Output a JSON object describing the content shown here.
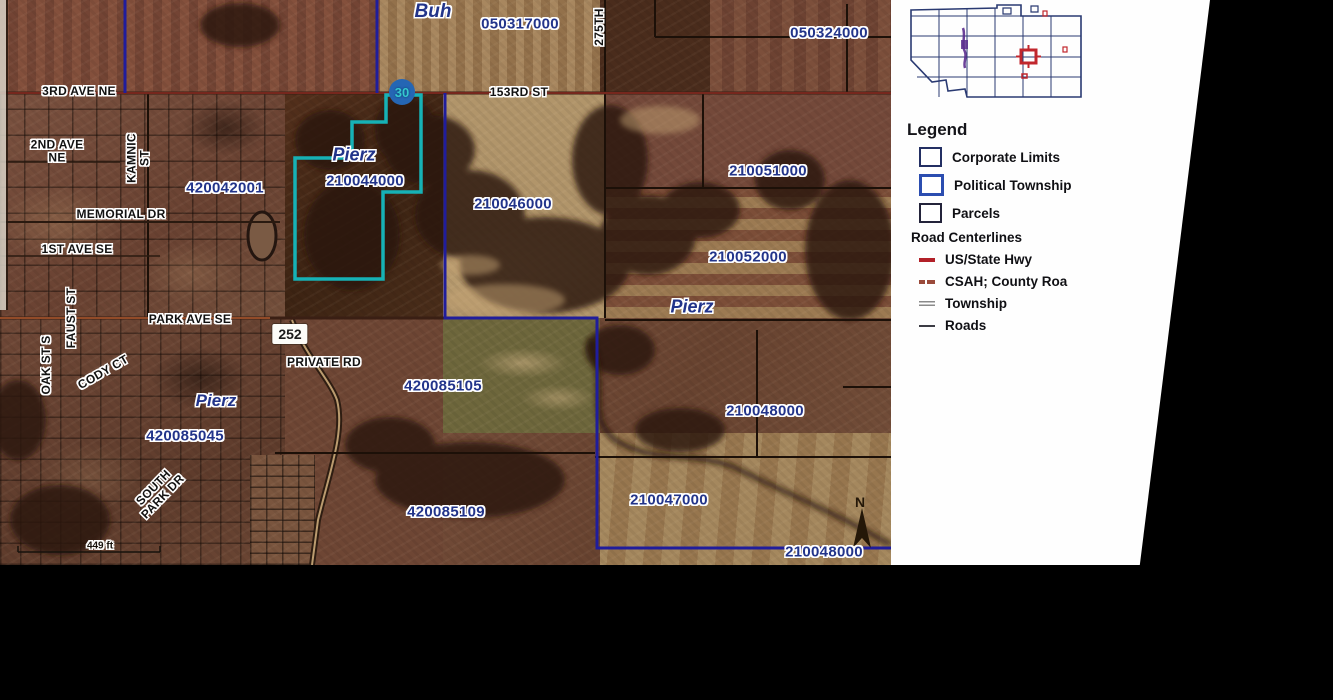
{
  "map": {
    "scale_label": "449 ft",
    "north_label": "N",
    "towns": [
      "Buh",
      "Pierz",
      "Pierz",
      "Pierz"
    ],
    "parcels": [
      "050317000",
      "050324000",
      "210044000",
      "420042001",
      "210051000",
      "210046000",
      "210052000",
      "420085105",
      "210048000",
      "420085045",
      "210047000",
      "420085109",
      "210048000"
    ],
    "roads": [
      "3RD AVE NE",
      "153RD ST",
      "275TH",
      "2ND AVE NE",
      "KAMNIC ST",
      "MEMORIAL DR",
      "1ST AVE SE",
      "PARK AVE SE",
      "PRIVATE RD",
      "OAK ST S",
      "FAUST ST",
      "CODY CT",
      "SOUTH PARK DR"
    ],
    "markers": {
      "county_road": "30",
      "highway": "252"
    }
  },
  "panel": {
    "legend": {
      "title": "Legend",
      "items": [
        {
          "label": "Corporate Limits"
        },
        {
          "label": "Political Township"
        },
        {
          "label": "Parcels"
        }
      ],
      "road_section": {
        "title": "Road Centerlines",
        "items": [
          {
            "label": "US/State Hwy"
          },
          {
            "label": "CSAH; County Roa"
          },
          {
            "label": "Township"
          },
          {
            "label": "Roads"
          }
        ]
      }
    }
  },
  "colors": {
    "selected_parcel_teal": "#16b2b6",
    "political_township_navy": "#201d9c",
    "parcel_label_navy": "#22348a",
    "us_state_hwy_red": "#b22028",
    "csah_orange": "#9a4a3a",
    "highlight_red": "#c1272d"
  }
}
